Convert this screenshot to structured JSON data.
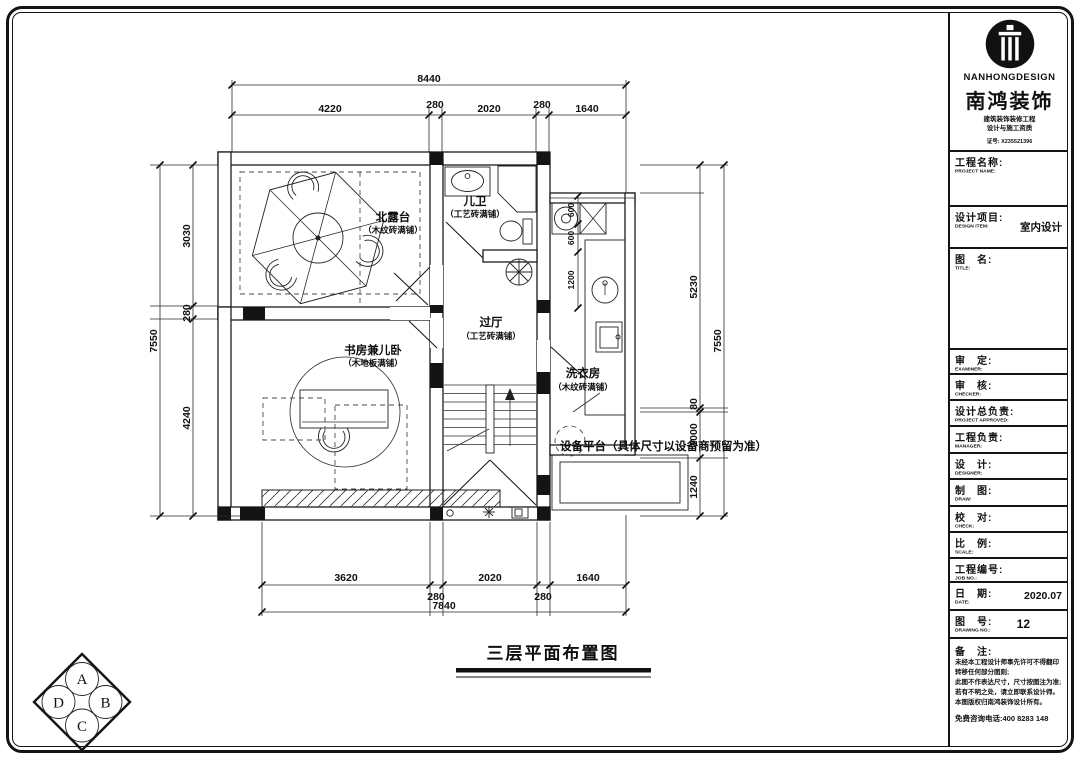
{
  "plan": {
    "title": "三层平面布置图",
    "rooms": [
      {
        "name": "北露台",
        "finish": "（木纹砖满铺）"
      },
      {
        "name": "儿卫",
        "finish": "（工艺砖满铺）"
      },
      {
        "name": "过厅",
        "finish": "（工艺砖满铺）"
      },
      {
        "name": "书房兼儿卧",
        "finish": "（木地板满铺）"
      },
      {
        "name": "洗衣房",
        "finish": "（木纹砖满铺）"
      }
    ],
    "equipment_note": "设备平台（具体尺寸以设备商预留为准）",
    "compass": {
      "top": "A",
      "right": "B",
      "bottom": "C",
      "left": "D"
    },
    "dimensions": {
      "top": {
        "overall": "8440",
        "segments": [
          "4220",
          "280",
          "2020",
          "280",
          "1640"
        ]
      },
      "bottom": {
        "overall": "7840",
        "segments": [
          "3620",
          "280",
          "2020",
          "280",
          "1640"
        ]
      },
      "left": {
        "overall": "7550",
        "segments": [
          "3030",
          "280",
          "4240"
        ]
      },
      "right": {
        "overall": "7550",
        "segments": [
          "5230",
          "80",
          "1000",
          "1240"
        ]
      },
      "laundry_interior": [
        "600",
        "600",
        "1200"
      ]
    }
  },
  "title_block": {
    "logo": {
      "brand_en": "NANHONGDESIGN",
      "brand_cn": "南鸿装饰",
      "line1": "建筑装饰装修工程",
      "line2": "设计与施工资质",
      "line3": "证号: X235521396"
    },
    "rows": [
      {
        "cn": "工程名称:",
        "en": "PROJECT NAME:",
        "value": ""
      },
      {
        "cn": "设计项目:",
        "en": "DESIGN ITEM:",
        "value": "室内设计"
      },
      {
        "cn": "图　名:",
        "en": "TITLE:",
        "value": ""
      },
      {
        "cn": "审　定:",
        "en": "EXAMINER:",
        "value": ""
      },
      {
        "cn": "审　核:",
        "en": "CHECKER:",
        "value": ""
      },
      {
        "cn": "设计总负责:",
        "en": "PROJECT APPROVED:",
        "value": ""
      },
      {
        "cn": "工程负责:",
        "en": "MANAGER:",
        "value": ""
      },
      {
        "cn": "设　计:",
        "en": "DESIGNER:",
        "value": ""
      },
      {
        "cn": "制　图:",
        "en": "DRAW:",
        "value": ""
      },
      {
        "cn": "校　对:",
        "en": "CHECK:",
        "value": ""
      },
      {
        "cn": "比　例:",
        "en": "SCALE:",
        "value": ""
      },
      {
        "cn": "工程编号:",
        "en": "JOB NO.:",
        "value": ""
      },
      {
        "cn": "日　期:",
        "en": "DATE:",
        "value": "2020.07"
      },
      {
        "cn": "图　号:",
        "en": "DRAWING NO.:",
        "value": "12"
      }
    ],
    "remarks": {
      "label": "备　注:",
      "lines": [
        "未经本工程设计师事先许可不得翻印转移任何部分图则;",
        "此图不作表达尺寸，尺寸按图注为准;",
        "若有不明之处，请立即联系设计师。",
        "本图版权归南鸿装饰设计所有。"
      ],
      "hotline": "免费咨询电话:400 8283 148"
    }
  }
}
